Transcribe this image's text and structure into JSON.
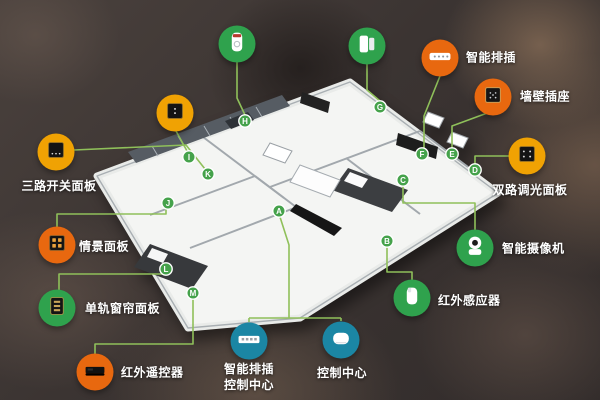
{
  "infographic": {
    "description": "smart home device floor plan map",
    "colors": {
      "green": "#2fa24d",
      "orange": "#e8680f",
      "amber": "#f0a203",
      "teal": "#1b86a4",
      "line": "#8fc05a",
      "marker_fill": "#45a24b"
    },
    "devices": [
      {
        "label": "燃气报警器",
        "letter": "H",
        "color": "green",
        "icon": "gas-alarm-icon"
      },
      {
        "label": "门磁/窗磁",
        "letter": "G",
        "color": "green",
        "icon": "door-window-sensor-icon"
      },
      {
        "label": "智能排插",
        "letter": "F",
        "color": "orange",
        "icon": "power-strip-icon"
      },
      {
        "label": "单路调光面板",
        "letter": "I",
        "color": "amber",
        "icon": "single-dimmer-panel-icon"
      },
      {
        "label": "墙壁插座",
        "letter": "E",
        "color": "orange",
        "icon": "wall-socket-icon"
      },
      {
        "label": "三路开关面板",
        "letter": "K",
        "color": "amber",
        "icon": "triple-switch-panel-icon"
      },
      {
        "label": "双路调光面板",
        "letter": "D",
        "color": "amber",
        "icon": "dual-dimmer-panel-icon"
      },
      {
        "label": "情景面板",
        "letter": "J",
        "color": "orange",
        "icon": "scene-panel-icon"
      },
      {
        "label": "智能摄像机",
        "letter": "C",
        "color": "green",
        "icon": "smart-camera-icon"
      },
      {
        "label": "单轨窗帘面板",
        "letter": "L",
        "color": "green",
        "icon": "curtain-panel-icon"
      },
      {
        "label": "红外感应器",
        "letter": "B",
        "color": "green",
        "icon": "ir-sensor-icon"
      },
      {
        "label": "红外遥控器",
        "letter": "M",
        "color": "orange",
        "icon": "ir-remote-icon"
      },
      {
        "label": "智能排插控制中心",
        "letter": "A",
        "color": "teal",
        "icon": "strip-hub-icon"
      },
      {
        "label": "控制中心",
        "letter": "A",
        "color": "teal",
        "icon": "control-hub-icon"
      }
    ],
    "floorplan_markers": [
      "A",
      "B",
      "C",
      "D",
      "E",
      "F",
      "G",
      "H",
      "I",
      "J",
      "K",
      "L",
      "M"
    ]
  }
}
